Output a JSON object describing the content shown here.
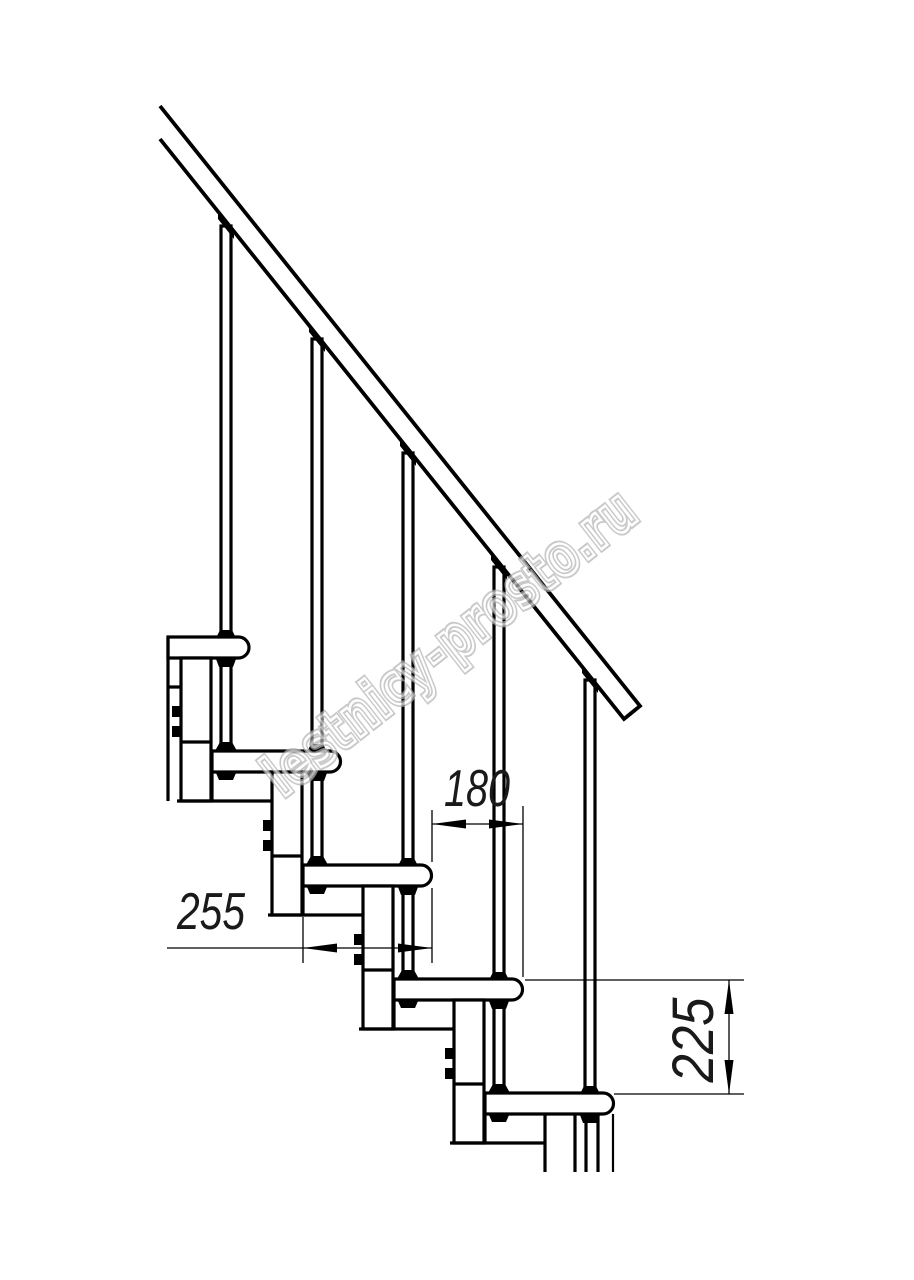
{
  "drawing": {
    "kind": "modular-staircase-side-view",
    "background_color": "#ffffff",
    "line_color": "#000000",
    "step_count_visible": 5,
    "dimensions": {
      "step_run": {
        "value": "180",
        "orientation": "horizontal"
      },
      "tread_depth": {
        "value": "255",
        "orientation": "horizontal"
      },
      "step_rise": {
        "value": "225",
        "orientation": "vertical"
      }
    },
    "watermark": {
      "text": "lestnicy-prosto.ru",
      "color": "#b3b3b3",
      "angle_deg": -38
    }
  }
}
